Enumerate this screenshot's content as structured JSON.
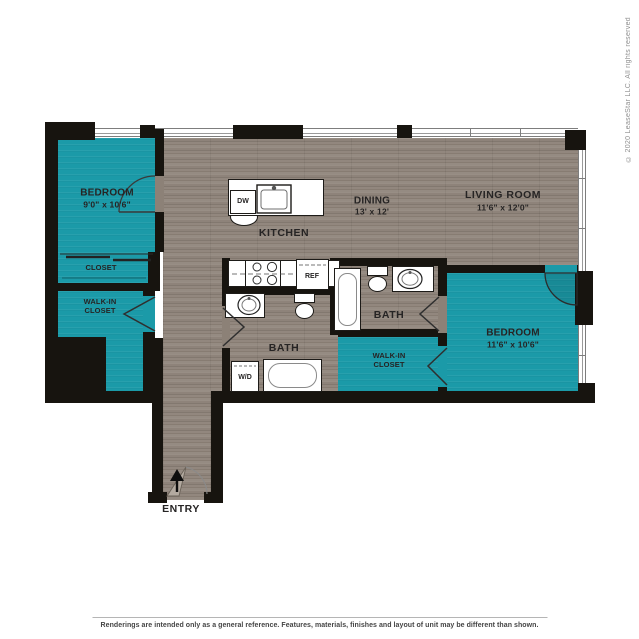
{
  "floor_plan": {
    "colors": {
      "room_fill": "#1b9aa8",
      "wall": "#17140f",
      "wood_floor": "#8c8177",
      "window_line": "#7d7d7d"
    },
    "rooms": {
      "bedroom_1": {
        "name": "BEDROOM",
        "dims": "9'0\" x 10'6\""
      },
      "closet_1": {
        "name": "CLOSET"
      },
      "walk_in_closet_1": {
        "line1": "WALK-IN",
        "line2": "CLOSET"
      },
      "kitchen": {
        "name": "KITCHEN"
      },
      "dining": {
        "name": "DINING",
        "dims": "13' x 12'"
      },
      "living_room": {
        "name": "LIVING ROOM",
        "dims": "11'6\" x 12'0\""
      },
      "bath_1": {
        "name": "BATH"
      },
      "bath_2": {
        "name": "BATH"
      },
      "walk_in_closet_2": {
        "line1": "WALK-IN",
        "line2": "CLOSET"
      },
      "bedroom_2": {
        "name": "BEDROOM",
        "dims": "11'6\" x 10'6\""
      },
      "entry": {
        "name": "ENTRY"
      }
    },
    "fixtures": {
      "dishwasher": "DW",
      "refrigerator": "REF",
      "washer_dryer": "W/D"
    }
  },
  "footer": {
    "disclaimer": "Renderings are intended only as a general reference. Features, materials, finishes and layout of unit may be different than shown."
  },
  "copyright": "© 2020 LeaseStar LLC. All rights reserved"
}
